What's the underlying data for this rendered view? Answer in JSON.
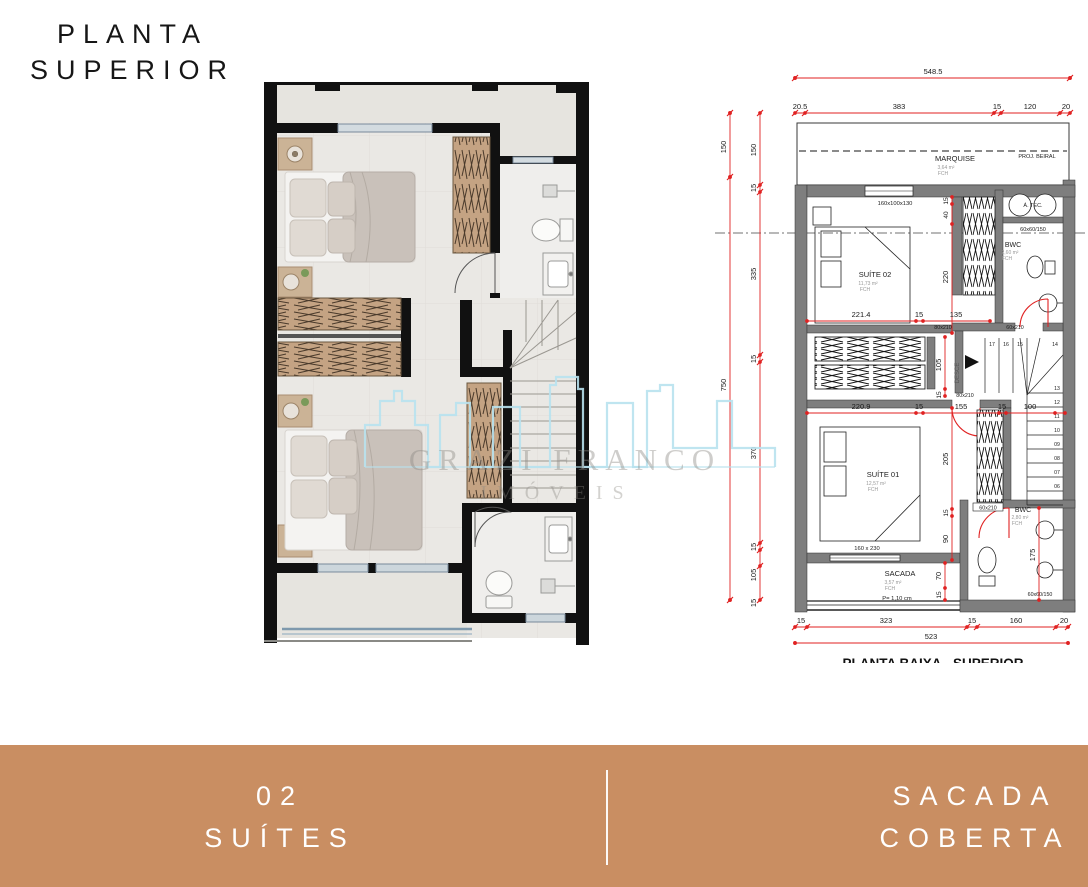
{
  "page": {
    "title_line1": "PLANTA",
    "title_line2": "SUPERIOR"
  },
  "watermark": {
    "brand": "GRAZI FRANCO",
    "subtitle": "IMÓVEIS"
  },
  "footer": {
    "left_line1": "02",
    "left_line2": "SUÍTES",
    "right_line1": "SACADA",
    "right_line2": "COBERTA",
    "bar_color": "#c98e62"
  },
  "colors": {
    "dimension_red": "#e02222",
    "wall_gray": "#7e7e7e",
    "watermark_blue": "#b8e2ee",
    "wood": "#c4a383",
    "floor": "#eae8e4"
  },
  "tech": {
    "bottom_title": "PLANTA BAIXA - SUPERIOR",
    "top_total": "548.5",
    "top_dims": [
      "20.5",
      "383",
      "15",
      "120",
      "20"
    ],
    "left_outer_dims": [
      "150",
      "750"
    ],
    "left_inner_dims": [
      "150",
      "15",
      "335",
      "15",
      "370",
      "15",
      "105",
      "15"
    ],
    "v_dims": [
      "15",
      "40",
      "220",
      "105",
      "15",
      "205",
      "15",
      "90",
      "70",
      "15",
      "175"
    ],
    "h_dims_suite02": [
      "221.4",
      "15",
      "135"
    ],
    "h_dims_suite01": [
      "220.9",
      "15",
      "155",
      "15",
      "100"
    ],
    "bottom_dims": [
      "15",
      "323",
      "15",
      "160",
      "20"
    ],
    "bottom_total": "523",
    "rooms": {
      "marquise": {
        "name": "MARQUISE",
        "area": "3,64 m²",
        "note": "FCH"
      },
      "proj_beiral": "PROJ. BEIRAL",
      "atec": "Á. TEC.",
      "suite02": {
        "name": "SUÍTE 02",
        "area": "11,73 m²",
        "note": "FCH"
      },
      "bwc_top": {
        "name": "BWC",
        "area": "2,60 m²",
        "note": "FCH"
      },
      "suite01": {
        "name": "SUÍTE 01",
        "area": "12,57 m²",
        "note": "FCH"
      },
      "bwc_bottom": {
        "name": "BWC",
        "area": "2,80 m²",
        "note": "FCH"
      },
      "sacada": {
        "name": "SACADA",
        "area": "3,57 m²",
        "note": "FCH",
        "extra": "P= 1,10 cm"
      }
    },
    "tags": {
      "bed02": "160x100x130",
      "shower_top": "60x60/150",
      "door_suite02": "80x210",
      "door_bwc_top": "60x210",
      "door_stair": "80x210",
      "bed01": "160 x 230",
      "door_bwc_bottom": "60x210",
      "shower_bottom": "60x60/150"
    },
    "stairs": {
      "desce": "DESCE",
      "numbers": [
        "17",
        "16",
        "15",
        "14",
        "13",
        "12",
        "11",
        "10",
        "09",
        "08",
        "07",
        "06"
      ]
    }
  }
}
